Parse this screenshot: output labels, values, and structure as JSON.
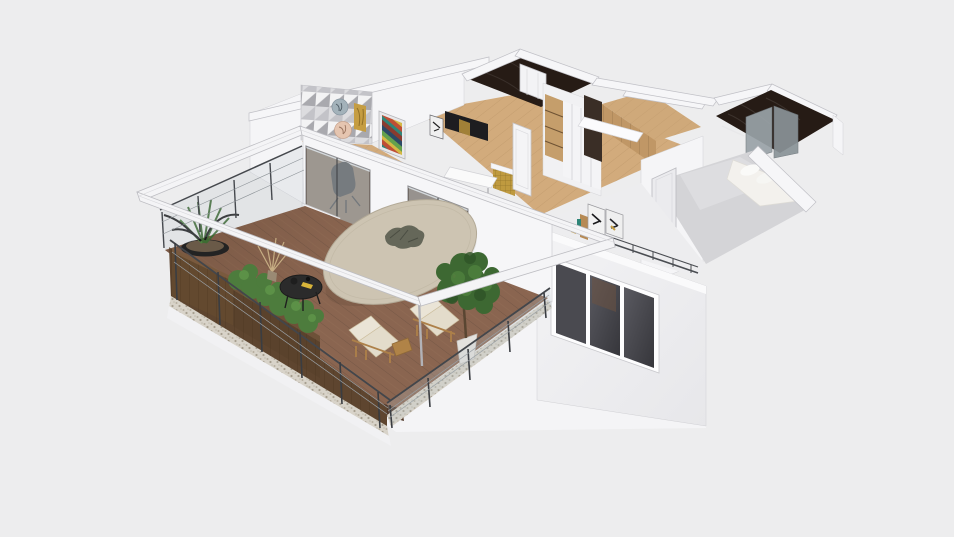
{
  "meta": {
    "app": "3d-floorplan-render",
    "view": "isometric-cutaway-top-view"
  },
  "scene": {
    "background": "#ededee",
    "palette": {
      "wall": "#f6f6f8",
      "wall_edge": "#c6c6cb",
      "deck_wood": "#8a6550",
      "deck_seam": "#68503e",
      "oak_floor": "#d2ab7c",
      "dark_marble": "#261b15",
      "glass": "#b9c2c6",
      "railing_metal": "#43464b",
      "planter_wood": "#5e452f",
      "plant_green": "#4d7c3d",
      "table_top": "#cdc4b2",
      "cushion": "#eae4d6",
      "lounger_frame": "#b08347",
      "coffee_table": "#2b2b2b",
      "bed_gray": "#d4d4d7",
      "duvet_white": "#f3f1ed",
      "gold_accent": "#bf9a3f",
      "window_glazing": "#4a4a50",
      "speckle_band": "#d8d3c9",
      "pergola_white": "#f4f4f6"
    },
    "objects": {
      "balcony": [
        "wood-deck",
        "cable-glass-railing",
        "planter-boxes",
        "crate-planter",
        "succulent-bowl",
        "hedge-plants",
        "round-dining-table",
        "black-coffee-table",
        "sun-lounger-left",
        "sun-lounger-right",
        "potted-tree",
        "white-pergola-frame"
      ],
      "interior": [
        "sliding-glass-doors",
        "desk-chair",
        "white-staircase",
        "triangle-mosaic-accent-wall",
        "wall-plate-art",
        "striped-painting",
        "tv-panel",
        "gold-kitchen-island",
        "white-dining-table",
        "wardrobe-closet",
        "wood-pantry-volume",
        "marble-bathroom-top",
        "marble-bathroom-right-with-shower",
        "bedroom-gray-bed-white-duvet",
        "hallway-leaning-art",
        "triple-window"
      ]
    }
  }
}
